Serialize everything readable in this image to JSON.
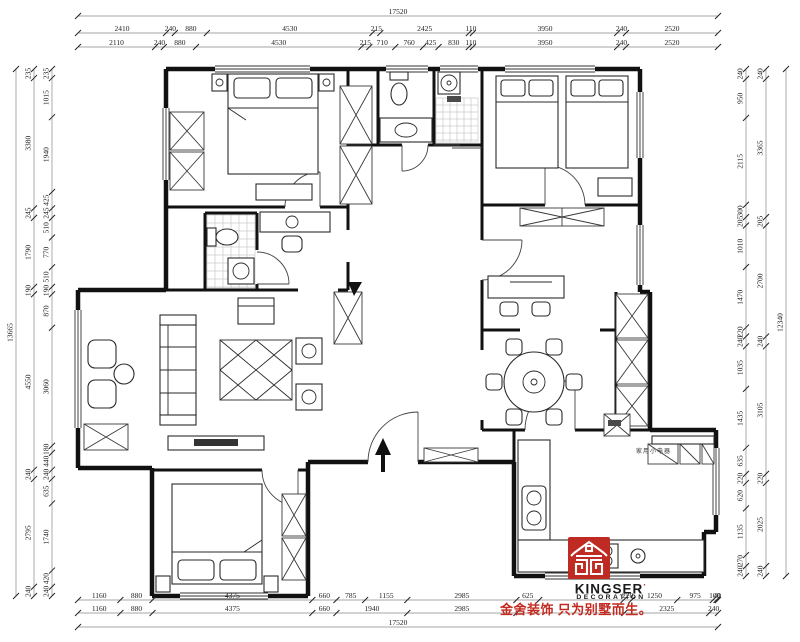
{
  "colors": {
    "background": "#ffffff",
    "line": "#111111",
    "dim_text": "#222222",
    "brand_red": "#bf2b22",
    "tagline_red": "#c22a1f"
  },
  "branding": {
    "logo_icon": "kingser-emblem-icon",
    "brand": "KINGSER",
    "brand_mark": "·",
    "subbrand": "DECORATION",
    "tagline": "金舍装饰 只为别墅而生。"
  },
  "plan_labels": {
    "appliance_counter": "家用小电器"
  },
  "icons": {
    "entry_arrow": "up-arrow"
  },
  "dimensions": {
    "top": {
      "total": "17520",
      "rows": [
        [
          2410,
          240,
          880,
          4530,
          215,
          2425,
          110,
          3950,
          240,
          2520
        ],
        [
          2110,
          240,
          880,
          4530,
          215,
          710,
          760,
          425,
          830,
          110,
          3950,
          240,
          2520
        ]
      ]
    },
    "bottom": {
      "total": "17520",
      "rows": [
        [
          1160,
          880,
          4375,
          660,
          785,
          1155,
          2985,
          625,
          {
            "v": 2310,
            "hide": true
          },
          220,
          1250,
          975,
          100,
          40
        ],
        [
          1160,
          880,
          4375,
          660,
          1940,
          2985,
          {
            "v": 2955,
            "hide": true
          },
          2325,
          240
        ]
      ]
    },
    "left": {
      "total": "13665",
      "cols": [
        [
          235,
          3380,
          245,
          1790,
          190,
          4550,
          240,
          2795,
          240
        ],
        [
          235,
          1015,
          1940,
          425,
          245,
          510,
          770,
          510,
          190,
          870,
          3060,
          180,
          440,
          240,
          635,
          1740,
          420,
          240
        ]
      ]
    },
    "right": {
      "total": "12340",
      "cols": [
        [
          240,
          3365,
          205,
          2700,
          240,
          3105,
          220,
          2025,
          240
        ],
        [
          240,
          950,
          2115,
          300,
          205,
          1010,
          1470,
          220,
          240,
          1035,
          1435,
          635,
          220,
          620,
          1135,
          270,
          240
        ]
      ]
    }
  }
}
